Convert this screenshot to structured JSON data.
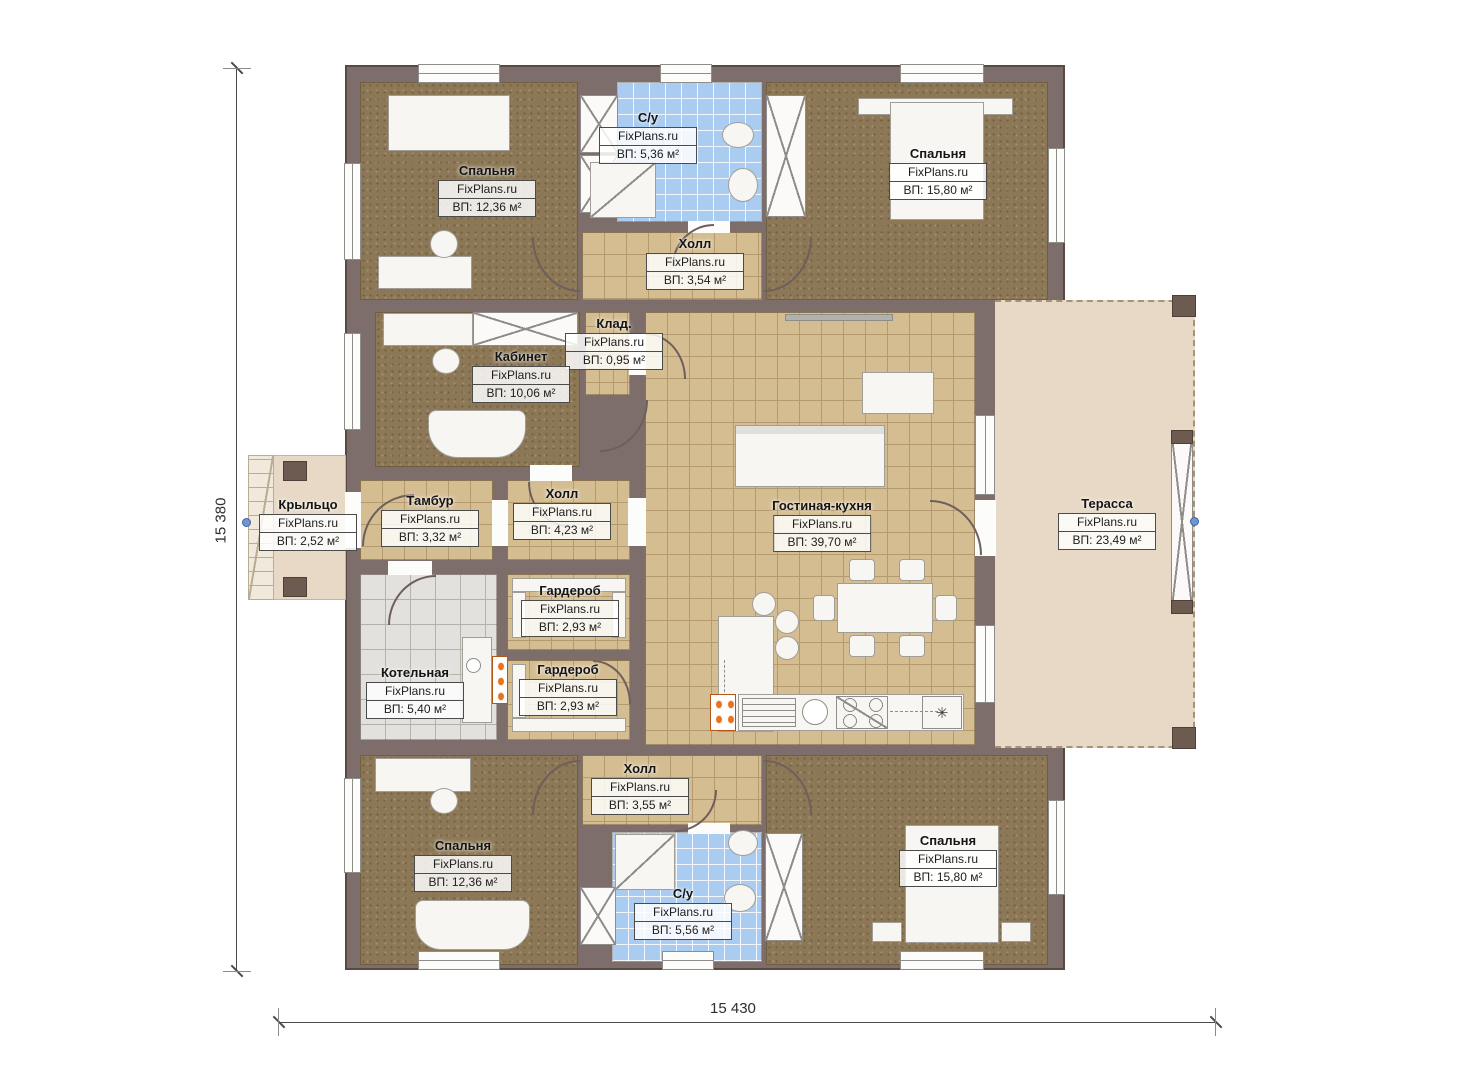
{
  "brand": "FixPlans.ru",
  "dimensions": {
    "height_label": "15 380",
    "width_label": "15 430"
  },
  "kitchen": {
    "fridge_symbol": "✳"
  },
  "colors": {
    "wall": "#7d6e6c",
    "carpet": "#8c7856",
    "tile_tan": "#d5bd92",
    "tile_blue": "#a9ccf0",
    "tile_grey": "#e3e1dd",
    "deck": "#e7d9c5",
    "burner_orange": "#e8731f",
    "marker_blue": "#7096cf"
  },
  "rooms": [
    {
      "name": "Спальня",
      "area": "ВП: 12,36 м²"
    },
    {
      "name": "С/у",
      "area": "ВП: 5,36 м²"
    },
    {
      "name": "Холл",
      "area": "ВП: 3,54 м²"
    },
    {
      "name": "Спальня",
      "area": "ВП: 15,80 м²"
    },
    {
      "name": "Клад.",
      "area": "ВП: 0,95 м²"
    },
    {
      "name": "Кабинет",
      "area": "ВП: 10,06 м²"
    },
    {
      "name": "Крыльцо",
      "area": "ВП: 2,52 м²"
    },
    {
      "name": "Тамбур",
      "area": "ВП: 3,32 м²"
    },
    {
      "name": "Холл",
      "area": "ВП: 4,23 м²"
    },
    {
      "name": "Гостиная-кухня",
      "area": "ВП: 39,70 м²"
    },
    {
      "name": "Терасса",
      "area": "ВП: 23,49 м²"
    },
    {
      "name": "Гардероб",
      "area": "ВП: 2,93 м²"
    },
    {
      "name": "Котельная",
      "area": "ВП: 5,40 м²"
    },
    {
      "name": "Гардероб",
      "area": "ВП: 2,93 м²"
    },
    {
      "name": "Холл",
      "area": "ВП: 3,55 м²"
    },
    {
      "name": "Спальня",
      "area": "ВП: 12,36 м²"
    },
    {
      "name": "С/у",
      "area": "ВП: 5,56 м²"
    },
    {
      "name": "Спальня",
      "area": "ВП: 15,80 м²"
    }
  ]
}
